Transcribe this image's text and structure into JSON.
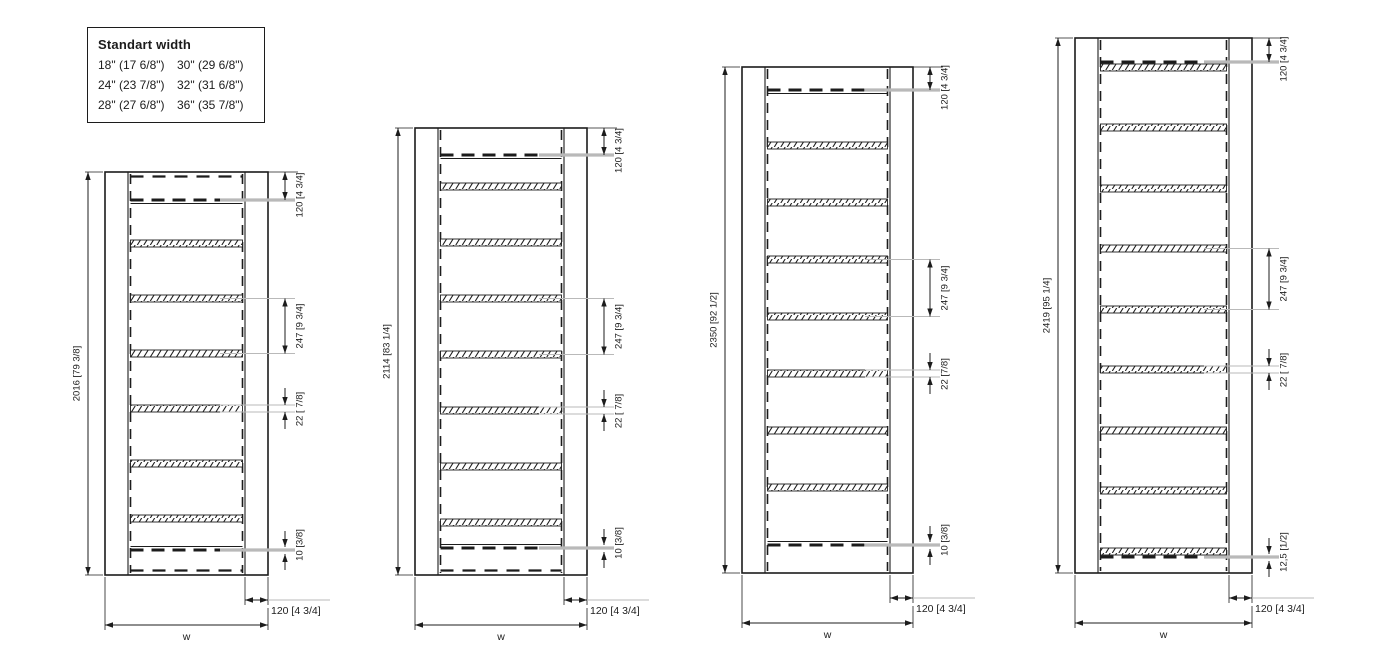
{
  "legend": {
    "title": "Standart width",
    "items": [
      "18\" (17 6/8\")",
      "30\" (29 6/8\")",
      "24\" (23 7/8\")",
      "32\" (31 6/8\")",
      "28\" (27 6/8\")",
      "36\" (35 7/8\")"
    ]
  },
  "ladders": [
    {
      "name": "ladder-2016",
      "labels": {
        "height": "2016 [79 3/8]",
        "top_offset": "120 [4 3/4]",
        "rung_spacing": "247 [9 3/4]",
        "rung_thickness": "22 [ 7/8]",
        "bottom_offset": "10 [3/8]",
        "rail_width": "120 [4 3/4]",
        "overall_width": "w"
      },
      "geometry": {
        "x": 105,
        "top": 172,
        "bottom": 575,
        "width": 163,
        "rail": 23,
        "top_dash_y": 200,
        "bottom_dash_y": 550,
        "rung_ys": [
          240,
          295,
          350,
          405,
          460,
          515
        ],
        "spacing_dim_rungs": [
          1,
          2
        ],
        "thickness_dim_rung": 3,
        "top_hidden_dash": true,
        "bottom_hidden_dash": true,
        "top_overlap": false,
        "bottom_overlap": false
      }
    },
    {
      "name": "ladder-2114",
      "labels": {
        "height": "2114 [83 1/4]",
        "top_offset": "120 [4 3/4]",
        "rung_spacing": "247 [9 3/4]",
        "rung_thickness": "22 [ 7/8]",
        "bottom_offset": "10 [3/8]",
        "rail_width": "120 [4 3/4]",
        "overall_width": "w"
      },
      "geometry": {
        "x": 415,
        "top": 128,
        "bottom": 575,
        "width": 172,
        "rail": 23,
        "top_dash_y": 155,
        "bottom_dash_y": 548,
        "rung_ys": [
          183,
          239,
          295,
          351,
          407,
          463,
          519
        ],
        "spacing_dim_rungs": [
          2,
          3
        ],
        "thickness_dim_rung": 4,
        "top_hidden_dash": false,
        "bottom_hidden_dash": true,
        "top_overlap": false,
        "bottom_overlap": false
      }
    },
    {
      "name": "ladder-2350",
      "labels": {
        "height": "2350 [92 1/2]",
        "top_offset": "120 [4 3/4]",
        "rung_spacing": "247 [9 3/4]",
        "rung_thickness": "22 [7/8]",
        "bottom_offset": "10 [3/8]",
        "rail_width": "120 [4 3/4]",
        "overall_width": "w"
      },
      "geometry": {
        "x": 742,
        "top": 67,
        "bottom": 573,
        "width": 171,
        "rail": 23,
        "top_dash_y": 90,
        "bottom_dash_y": 545,
        "rung_ys": [
          142,
          199,
          256,
          313,
          370,
          427,
          484
        ],
        "spacing_dim_rungs": [
          2,
          3
        ],
        "thickness_dim_rung": 4,
        "top_hidden_dash": false,
        "bottom_hidden_dash": false,
        "top_overlap": false,
        "bottom_overlap": false
      }
    },
    {
      "name": "ladder-2419",
      "labels": {
        "height": "2419 [95 1/4]",
        "top_offset": "120 [4 3/4]",
        "rung_spacing": "247 [9 3/4]",
        "rung_thickness": "22 [ 7/8]",
        "bottom_offset": "12,5 [1/2]",
        "rail_width": "120 [4 3/4]",
        "overall_width": "w"
      },
      "geometry": {
        "x": 1075,
        "top": 38,
        "bottom": 573,
        "width": 177,
        "rail": 23,
        "top_dash_y": 62,
        "bottom_dash_y": 557,
        "rung_ys": [
          64,
          124,
          185,
          245,
          306,
          366,
          427,
          487,
          548
        ],
        "spacing_dim_rungs": [
          3,
          4
        ],
        "thickness_dim_rung": 5,
        "top_hidden_dash": false,
        "bottom_hidden_dash": false,
        "top_overlap": true,
        "bottom_overlap": true
      }
    }
  ]
}
